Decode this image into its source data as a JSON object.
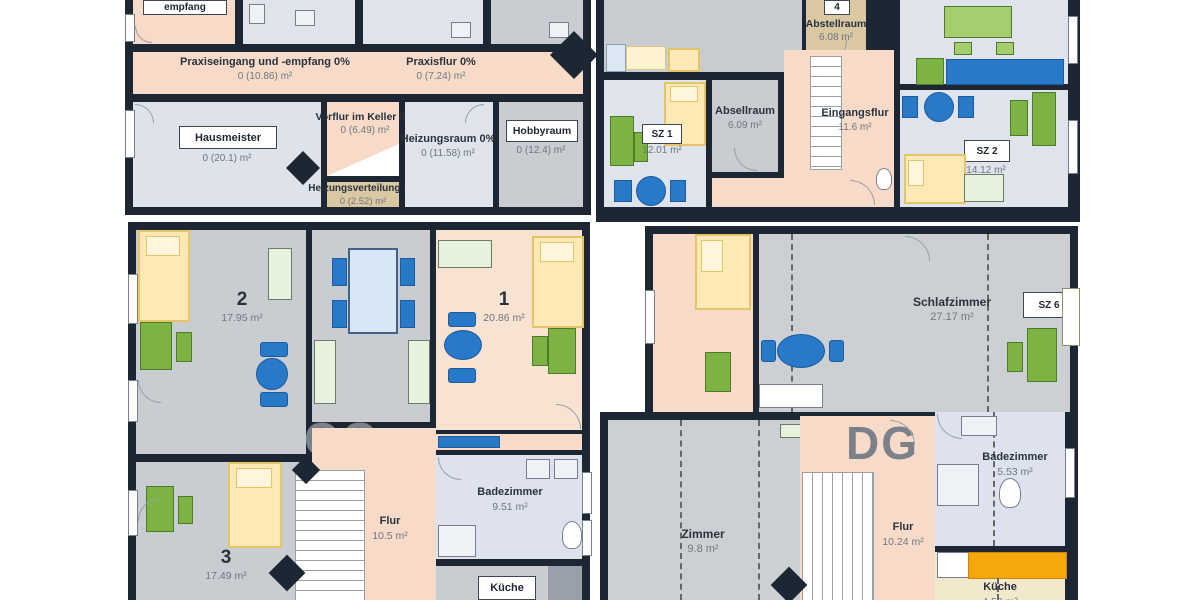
{
  "plan_title": "Gebäude-Grundrisse (KG / EG / OG / DG)",
  "colors": {
    "walls": "#1d2733",
    "corridor_peach": "#f7dbc8",
    "room_gray": "#c9cdd1",
    "room_blue_gray": "#dfe3ec",
    "room_light_blue": "#dde2ee",
    "room_tan": "#d9c8a2",
    "room_beige": "#f2e8cc",
    "room_peach_light": "#f8e3d3",
    "furniture_green": "#7cb342",
    "furniture_blue": "#2979c9",
    "furniture_yellow": "#fce9b5",
    "furniture_pale_green": "#e7f2dc",
    "kitchen_counter_orange": "#f6a80b",
    "big_label_gray": "#7b818a"
  },
  "kg": {
    "big_label": "KG",
    "empfang_box": "empfang",
    "praxiseingang": {
      "name": "Praxiseingang und -empfang 0%",
      "area": "0 (10.86) m²"
    },
    "praxisflur": {
      "name": "Praxisflur 0%",
      "area": "0 (7.24) m²"
    },
    "hausmeister": {
      "name": "Hausmeister",
      "area": "0 (20.1) m²"
    },
    "vorflur": {
      "name": "Vorflur im Keller 0%",
      "area": "0 (6.49) m²"
    },
    "heizungsraum": {
      "name": "Heizungsraum 0%",
      "area": "0 (11.58) m²"
    },
    "hobbyraum": {
      "name": "Hobbyraum",
      "area": "0 (12.4) m²"
    },
    "heizungsverteilung": {
      "name": "Heizungsverteilung 0%",
      "area": "0 (2.52) m²"
    }
  },
  "eg": {
    "big_label": "EG",
    "abstellraum": {
      "tag": "4",
      "name": "Abstellraum",
      "area": "6.08 m²"
    },
    "sz1": {
      "tag": "SZ 1",
      "area": "12.01 m²"
    },
    "absellraum": {
      "name": "Absellraum",
      "area": "6.09 m²"
    },
    "eingangsflur": {
      "name": "Eingangsflur",
      "area": "11.6 m²"
    },
    "sz2": {
      "tag": "SZ 2",
      "area": "14.12 m²"
    }
  },
  "og": {
    "big_label": "OG",
    "room2": {
      "name": "2",
      "area": "17.95 m²"
    },
    "room1": {
      "name": "1",
      "area": "20.86 m²"
    },
    "room3": {
      "name": "3",
      "area": "17.49 m²"
    },
    "flur": {
      "name": "Flur",
      "area": "10.5 m²"
    },
    "badezimmer": {
      "name": "Badezimmer",
      "area": "9.51 m²"
    },
    "kueche": {
      "name": "Küche"
    }
  },
  "dg": {
    "big_label": "DG",
    "schlafzimmer": {
      "name": "Schlafzimmer",
      "tag": "SZ 6",
      "area": "27.17 m²"
    },
    "zimmer": {
      "name": "Zimmer",
      "area": "9.8 m²"
    },
    "flur": {
      "name": "Flur",
      "area": "10.24 m²"
    },
    "badezimmer": {
      "name": "Badezimmer",
      "area": "5.53 m²"
    },
    "kueche": {
      "name": "Küche",
      "area": "4.52 m²"
    }
  }
}
